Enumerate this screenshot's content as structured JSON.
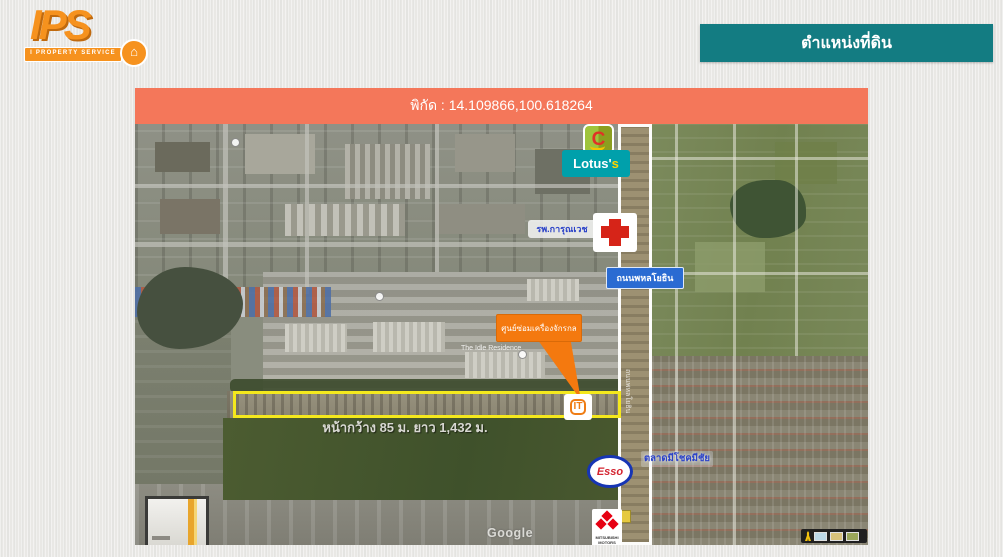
{
  "branding": {
    "logo_text": "IPS",
    "logo_subtitle": "I PROPERTY SERVICE",
    "logo_badge_glyph": "⌂"
  },
  "title_banner": {
    "text": "ตำแหน่งที่ดิน",
    "color": "#137c82"
  },
  "coordinates_banner": {
    "text": "พิกัด : 14.109866,100.618264",
    "color": "#f4775a"
  },
  "map": {
    "overlays": {
      "bigc_letter": "C",
      "lotus_main": "Lotus'",
      "lotus_suffix": "s",
      "hospital_label": "รพ.การุณเวช",
      "road_label": "ถนนพหลโยธิน",
      "road_label_vertical": "ถนนพหลโยธิน",
      "place_label": "The Idle Residence",
      "callout_label": "ศูนย์ซ่อมเครื่องจักรกล",
      "parcel_marker_text": "IT",
      "dimensions_label": "หน้ากว้าง 85 ม.  ยาว 1,432 ม.",
      "esso_label": "Esso",
      "market_label": "ตลาดมีโชคมีชัย",
      "mitsubishi_label": "MITSUBISHI MOTORS",
      "google_watermark": "Google"
    },
    "accent_colors": {
      "parcel_outline_yellow": "#f4e81d",
      "callout_orange": "#f4790f",
      "road_sign_blue": "#2a6bd2",
      "hospital_text_blue": "#2b42c8",
      "lotus_teal": "#00a0ab",
      "esso_red": "#d42430",
      "mitsubishi_red": "#e60012"
    }
  }
}
